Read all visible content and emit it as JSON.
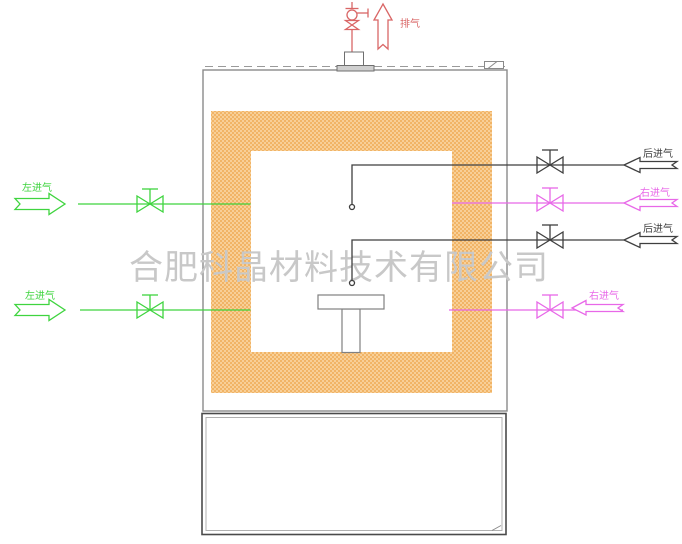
{
  "watermark": {
    "text": "合肥科晶材料技术有限公司",
    "color": "#c8c8c8"
  },
  "exhaust": {
    "label": "排气",
    "color": "#d96666"
  },
  "left_inlet": {
    "top_label": "左进气",
    "bottom_label": "左进气",
    "color": "#3fd43f"
  },
  "rear_inlet": {
    "top_label": "后进气",
    "bottom_label": "后进气",
    "color": "#3f3f3f"
  },
  "right_inlet": {
    "top_label": "右进气",
    "bottom_label": "右进气",
    "color": "#e868e8"
  },
  "structure": {
    "outline_color": "#8a8a8a",
    "cabinet_color": "#4a4a4a",
    "flange_color": "#6f6f6f",
    "insulation_base": "#f8cf97",
    "insulation_dot": "#eca143"
  }
}
